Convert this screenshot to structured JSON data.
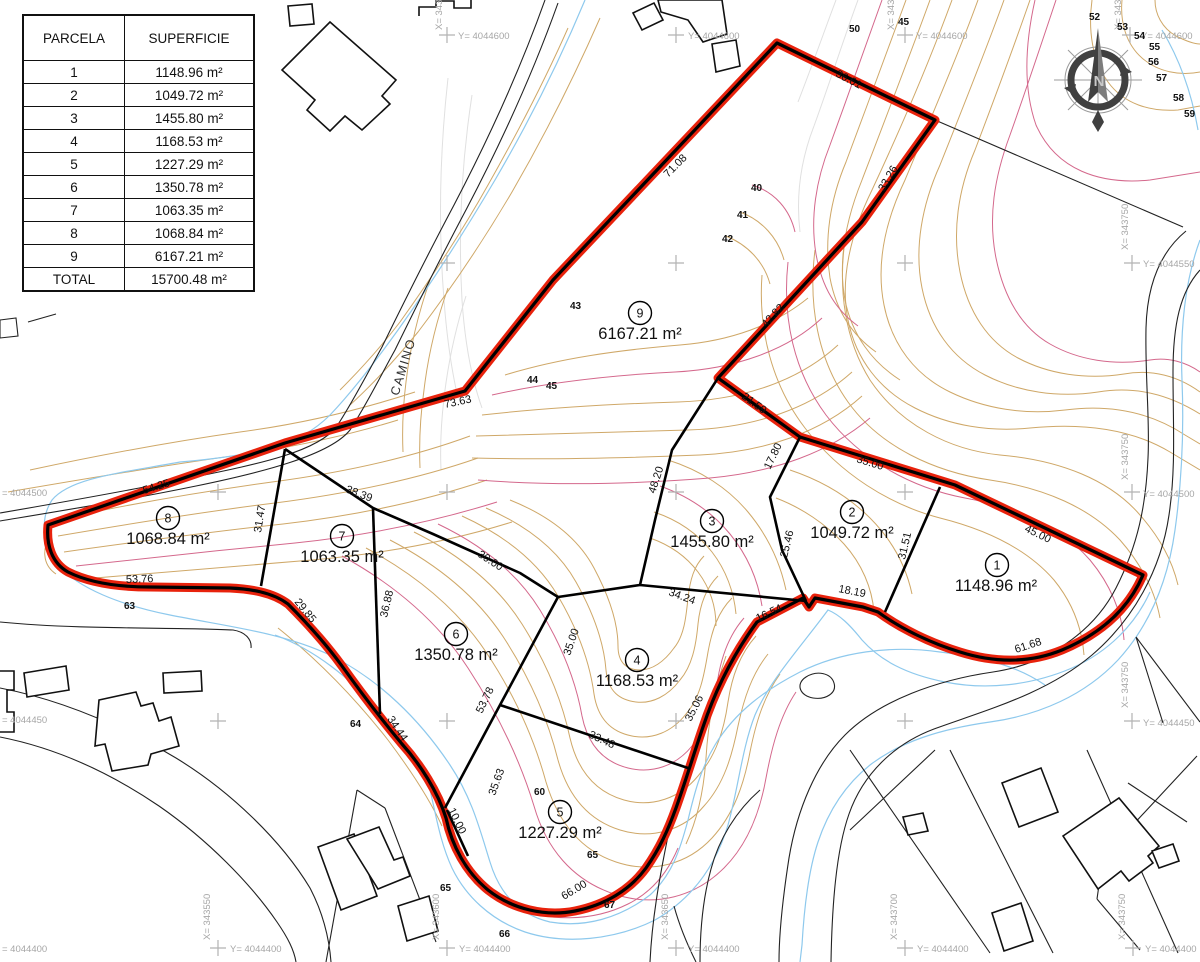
{
  "table": {
    "headers": [
      "PARCELA",
      "SUPERFICIE"
    ],
    "rows": [
      [
        "1",
        "1148.96 m²"
      ],
      [
        "2",
        "1049.72 m²"
      ],
      [
        "3",
        "1455.80 m²"
      ],
      [
        "4",
        "1168.53 m²"
      ],
      [
        "5",
        "1227.29 m²"
      ],
      [
        "6",
        "1350.78 m²"
      ],
      [
        "7",
        "1063.35 m²"
      ],
      [
        "8",
        "1068.84 m²"
      ],
      [
        "9",
        "6167.21 m²"
      ],
      [
        "TOTAL",
        "15700.48 m²"
      ]
    ]
  },
  "parcels": {
    "p1": {
      "n": "1",
      "a": "1148.96 m²"
    },
    "p2": {
      "n": "2",
      "a": "1049.72 m²"
    },
    "p3": {
      "n": "3",
      "a": "1455.80 m²"
    },
    "p4": {
      "n": "4",
      "a": "1168.53 m²"
    },
    "p5": {
      "n": "5",
      "a": "1227.29 m²"
    },
    "p6": {
      "n": "6",
      "a": "1350.78 m²"
    },
    "p7": {
      "n": "7",
      "a": "1063.35 m²"
    },
    "p8": {
      "n": "8",
      "a": "1068.84 m²"
    },
    "p9": {
      "n": "9",
      "a": "6167.21 m²"
    }
  },
  "dims": [
    "36.61",
    "33.26",
    "71.08",
    "42.82",
    "21.59",
    "35.00",
    "45.00",
    "61.68",
    "18.19",
    "16.54",
    "35.06",
    "34.24",
    "33.48",
    "48.20",
    "17.80",
    "25.46",
    "31.51",
    "73.63",
    "54.25",
    "53.76",
    "29.85",
    "31.47",
    "38.39",
    "30.00",
    "36.88",
    "53.78",
    "35.00",
    "35.63",
    "10.00",
    "34.44",
    "66.00"
  ],
  "elevations": [
    "50",
    "45",
    "52",
    "53",
    "54",
    "55",
    "56",
    "57",
    "58",
    "59",
    "40",
    "41",
    "42",
    "43",
    "44",
    "45",
    "63",
    "64",
    "60",
    "65",
    "65",
    "66",
    "67"
  ],
  "grid": {
    "y600": "Y= 4044600",
    "y550": "Y= 4044550",
    "y500": "Y= 4044500",
    "y450": "Y= 4044450",
    "y400": "Y= 4044400",
    "y500l": "= 4044500",
    "y450l": "= 4044450",
    "y400l": "= 4044400",
    "x550": "X= 343550",
    "x600": "X= 343600",
    "x650": "X= 343650",
    "x700": "X= 343700",
    "x750": "X= 343750"
  },
  "camino": "CAMINO",
  "compass": {
    "n": "N"
  },
  "colors": {
    "boundary_red": "#e8220c",
    "parcel_line_black": "#000000",
    "contour_tan": "#cfa868",
    "contour_index_pink": "#d4688c",
    "contour_grey": "#e0e0e0",
    "stream_blue": "#8ec9ed",
    "grid_grey": "#a6a6a6"
  }
}
